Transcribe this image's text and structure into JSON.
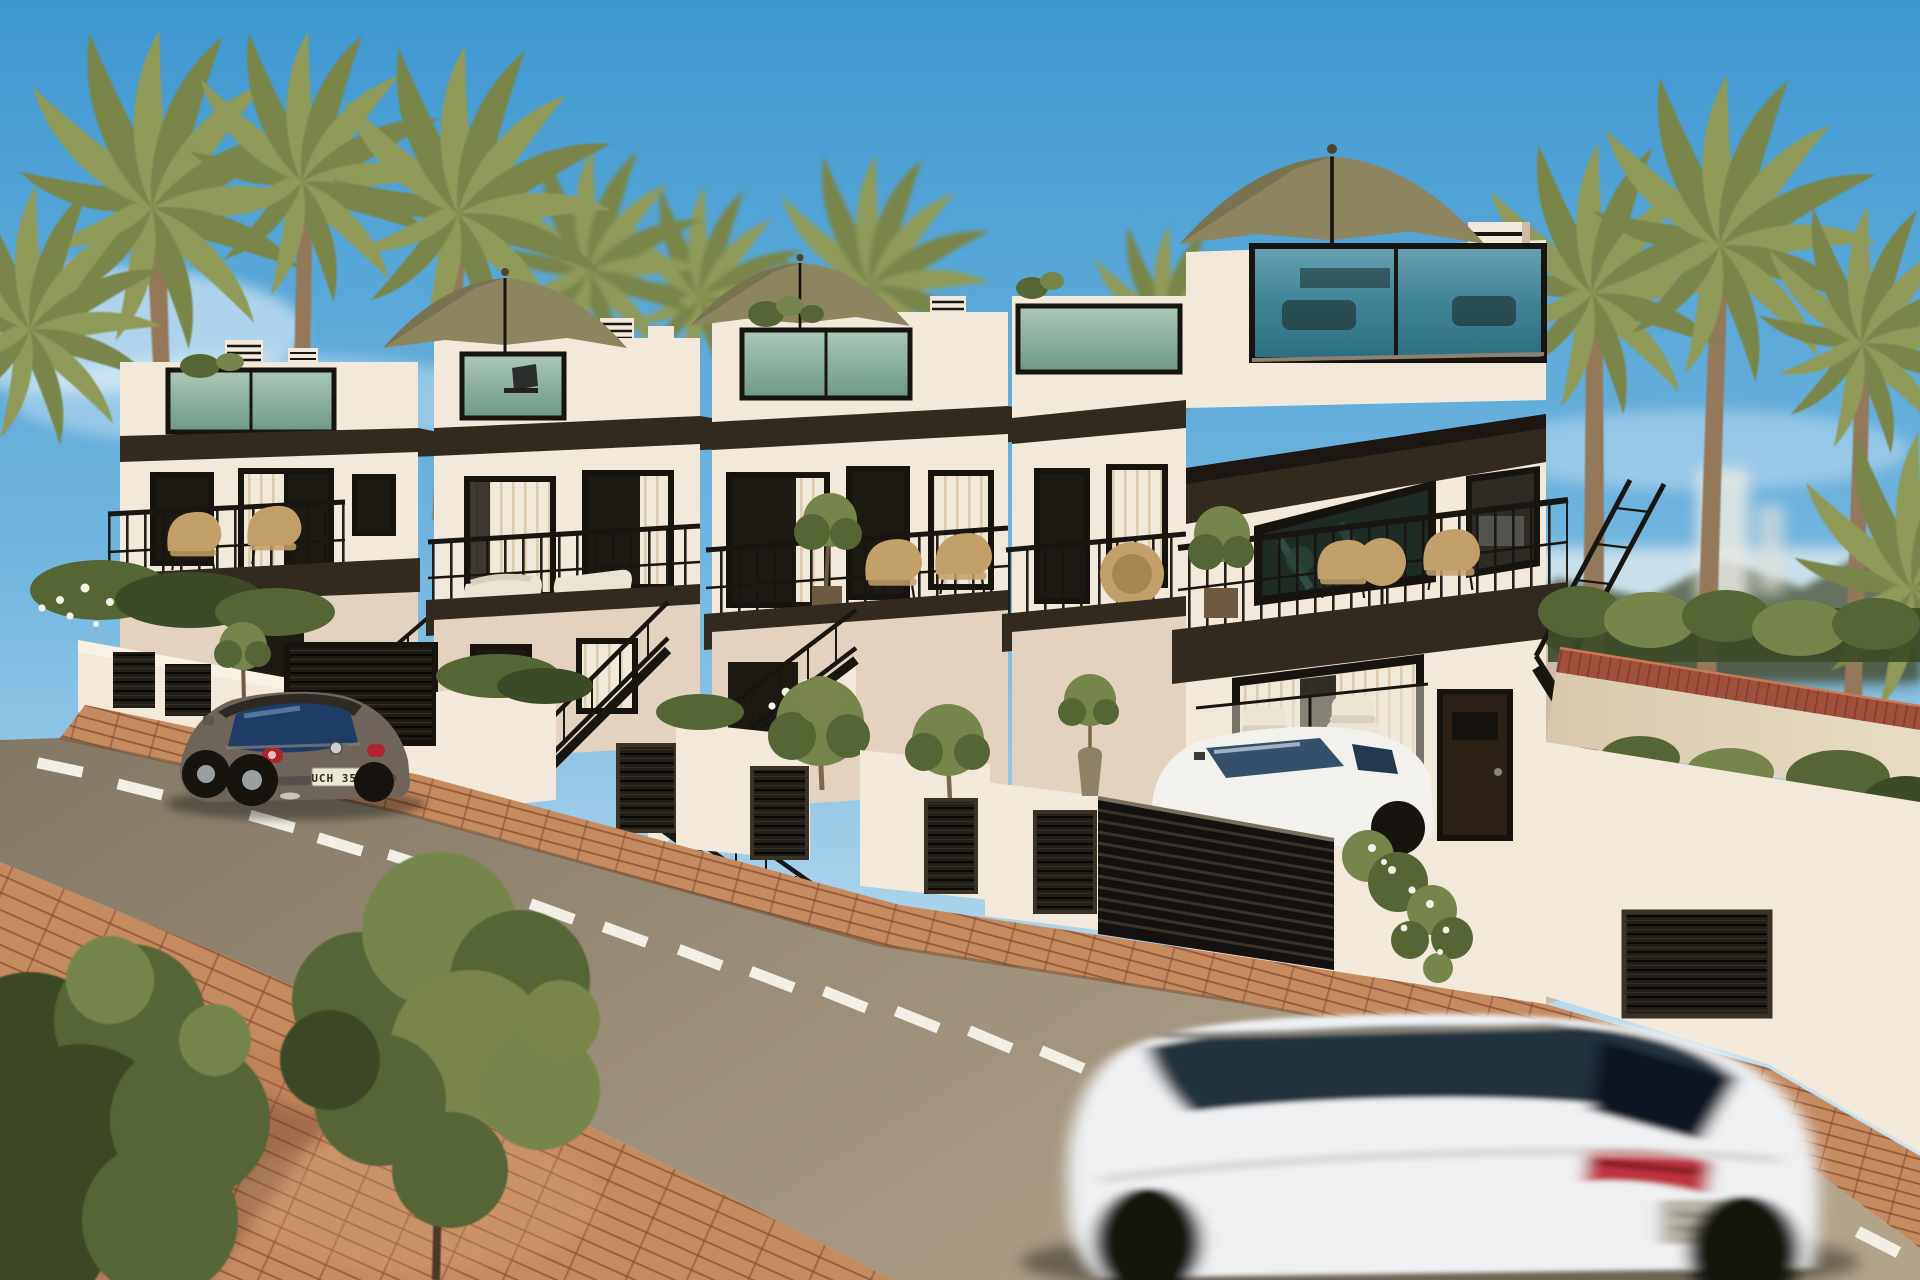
{
  "scene": {
    "description": "Photorealistic 3D exterior rendering of a row of five modern white terraced townhouses with rooftop glass-balustrade terraces, tan parasols, black metal staircases and balconies, street-level planters with olive trees and slatted garage doors, palm trees behind, a brick-paved sidewalk, a parked brown VW Beetle and a motion-blurred white SUV driving past in the foreground.",
    "houses_count": 5,
    "beetle_plate": "UCH 352"
  },
  "palette": {
    "skyTop": "#3e97d0",
    "skyHorizon": "#ddeef6",
    "wallLight": "#f3e9da",
    "wallMid": "#e3d2c0",
    "wallShade": "#cdbaa8",
    "fasciaDark": "#32291f",
    "nearBlack": "#17130e",
    "glassDark": "#1d1913",
    "glassTealTop": "#adc9b8",
    "glassTealBot": "#6d9886",
    "bigGlassTeal": "#3f8496",
    "curtain": "#f0e8d8",
    "railing": "#191511",
    "hedgeDark": "#3c4a28",
    "hedgeMid": "#566534",
    "hedgeLight": "#76864b",
    "palmGreen": "#8f9a58",
    "palmOlive": "#79854a",
    "trunkBrown": "#93785a",
    "potBrown": "#6e5a43",
    "rattan": "#c3a06a",
    "whiteChair": "#ece4d2",
    "roadDark": "#837866",
    "roadLight": "#b2a38b",
    "brickBase": "#c68a5f",
    "brickJoint": "#8a4f33",
    "rampBrick": "#a04f3a",
    "laneDash": "#f2efe6",
    "umbrella": "#8d855f",
    "beetleBody": "#6e6459",
    "beetleRoof": "#2e2922",
    "beetleGlass": "#1d3d66",
    "tailRed": "#b02430",
    "plateBg": "#ece8d6",
    "plateText": "#2a2a26",
    "suvBody": "#eef0f2",
    "suvGlass": "#1b2836",
    "hillOlive": "#55604a",
    "seaHaze": "#d9e7ec"
  }
}
